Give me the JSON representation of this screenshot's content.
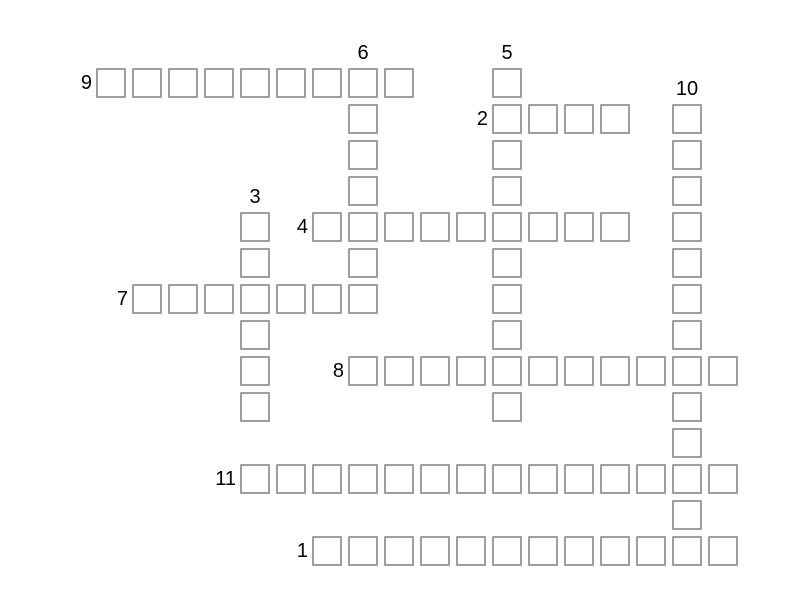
{
  "page": {
    "background": "#ffffff"
  },
  "crossword": {
    "colors": {
      "cell_border": "#9e9e9e",
      "cell_fill": "#ffffff",
      "number_text": "#000000"
    },
    "words": [
      {
        "number": "1",
        "direction": "across",
        "row": 13,
        "col": 6,
        "length": 12
      },
      {
        "number": "2",
        "direction": "across",
        "row": 1,
        "col": 11,
        "length": 4
      },
      {
        "number": "3",
        "direction": "down",
        "row": 4,
        "col": 4,
        "length": 6
      },
      {
        "number": "4",
        "direction": "across",
        "row": 4,
        "col": 6,
        "length": 9
      },
      {
        "number": "5",
        "direction": "down",
        "row": 0,
        "col": 11,
        "length": 10
      },
      {
        "number": "6",
        "direction": "down",
        "row": 0,
        "col": 7,
        "length": 7
      },
      {
        "number": "7",
        "direction": "across",
        "row": 6,
        "col": 1,
        "length": 7
      },
      {
        "number": "8",
        "direction": "across",
        "row": 8,
        "col": 7,
        "length": 11
      },
      {
        "number": "9",
        "direction": "across",
        "row": 0,
        "col": 0,
        "length": 9
      },
      {
        "number": "10",
        "direction": "down",
        "row": 1,
        "col": 16,
        "length": 13
      },
      {
        "number": "11",
        "direction": "across",
        "row": 11,
        "col": 4,
        "length": 14
      }
    ]
  }
}
